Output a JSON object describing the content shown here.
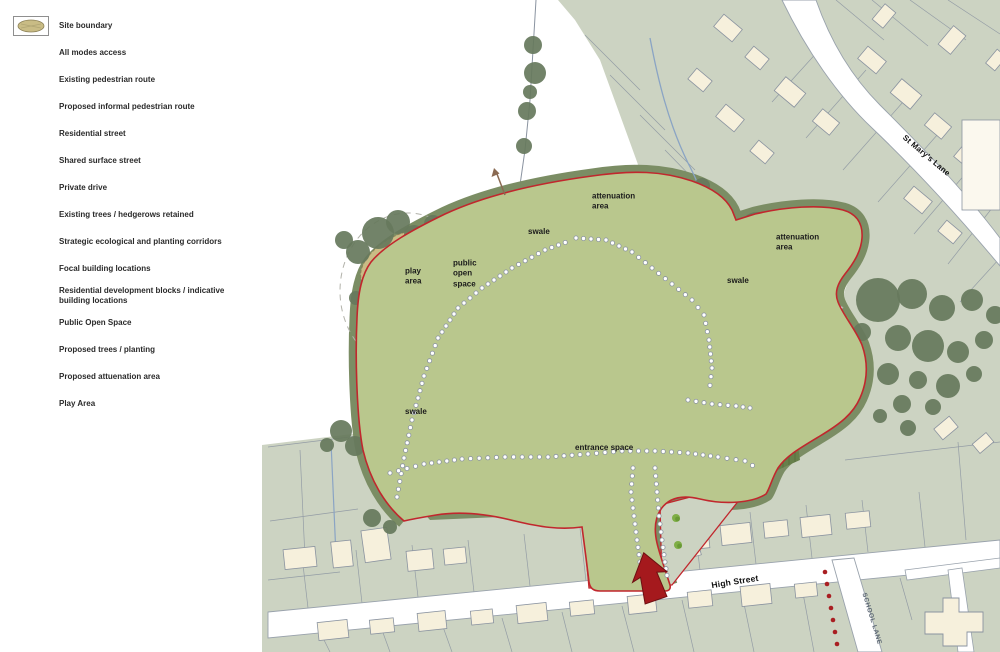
{
  "colors": {
    "site_boundary_red": "#c1272d",
    "access_arrow_red": "#a5191d",
    "ped_dot_red": "#a91e22",
    "context_green": "#ccd3c2",
    "building_cream": "#f6f0dc",
    "outline_gray": "#8a93a0",
    "open_space_green": "#b9c78d",
    "grid_line": "#cbd6a0",
    "corridor_green": "#7b8d64",
    "block_green": "#67804b",
    "street_gray": "#d6d6da",
    "shared_tan": "#d9cf9d",
    "drive_khaki": "#e4dca8",
    "focal_orange": "#e8902e",
    "tree_dark": "#66785c",
    "tree_bright": "#7fae46",
    "attenuation_blue": "#c6cfe6",
    "play_tan": "#c9bc85",
    "stream_blue": "#8aa4c4"
  },
  "legend": {
    "items": [
      {
        "label": "Site boundary",
        "type": "site-boundary"
      },
      {
        "label": "All modes access",
        "type": "all-modes-access"
      },
      {
        "label": "Existing pedestrian route",
        "type": "existing-ped"
      },
      {
        "label": "Proposed informal pedestrian route",
        "type": "proposed-ped"
      },
      {
        "label": "Residential street",
        "type": "fill",
        "color": "#d9d9e0"
      },
      {
        "label": "Shared surface street",
        "type": "fill",
        "color": "#d8cd99"
      },
      {
        "label": "Private drive",
        "type": "fill",
        "color": "#e4dca6"
      },
      {
        "label": "Existing trees / hedgerows retained",
        "type": "existing-tree"
      },
      {
        "label": "Strategic ecological and planting corridors",
        "type": "fill",
        "color": "#8d9e71"
      },
      {
        "label": "Focal building locations",
        "type": "focal"
      },
      {
        "label": "Residential development blocks / indicative building locations",
        "type": "res-block"
      },
      {
        "label": "Public Open Space",
        "type": "fill-grid",
        "color": "#b5c48c"
      },
      {
        "label": "Proposed trees / planting",
        "type": "proposed-tree"
      },
      {
        "label": "Proposed attuenation area",
        "type": "attenuation"
      },
      {
        "label": "Play Area",
        "type": "play-area"
      }
    ]
  },
  "map": {
    "area_labels": [
      {
        "name": "attenuation-area-1-label",
        "text": "attenuation\narea",
        "x": 592,
        "y": 202,
        "size": 8
      },
      {
        "name": "swale-1-label",
        "text": "swale",
        "x": 528,
        "y": 232,
        "size": 8
      },
      {
        "name": "play-area-label",
        "text": "play\narea",
        "x": 405,
        "y": 277,
        "size": 8
      },
      {
        "name": "public-open-space-label",
        "text": "public\nopen\nspace",
        "x": 453,
        "y": 274,
        "size": 8
      },
      {
        "name": "attenuation-area-2-label",
        "text": "attenuation\narea",
        "x": 776,
        "y": 243,
        "size": 8
      },
      {
        "name": "swale-2-label",
        "text": "swale",
        "x": 727,
        "y": 281,
        "size": 8
      },
      {
        "name": "swale-3-label",
        "text": "swale",
        "x": 405,
        "y": 412,
        "size": 8
      },
      {
        "name": "entrance-space-label",
        "text": "entrance space",
        "x": 575,
        "y": 448,
        "size": 8
      }
    ],
    "road_labels": [
      {
        "name": "high-street-label",
        "text": "High Street",
        "x": 735,
        "y": 582,
        "rotate": -9,
        "size": 8.5,
        "color": "#111111"
      },
      {
        "name": "st-marys-lane-label",
        "text": "St Mary's Lane",
        "x": 926,
        "y": 156,
        "rotate": 40,
        "size": 8,
        "color": "#111111"
      },
      {
        "name": "school-lane-label",
        "text": "SCHOOL LANE",
        "x": 871,
        "y": 619,
        "rotate": 73,
        "size": 6.5,
        "color": "#5b6672"
      }
    ]
  }
}
